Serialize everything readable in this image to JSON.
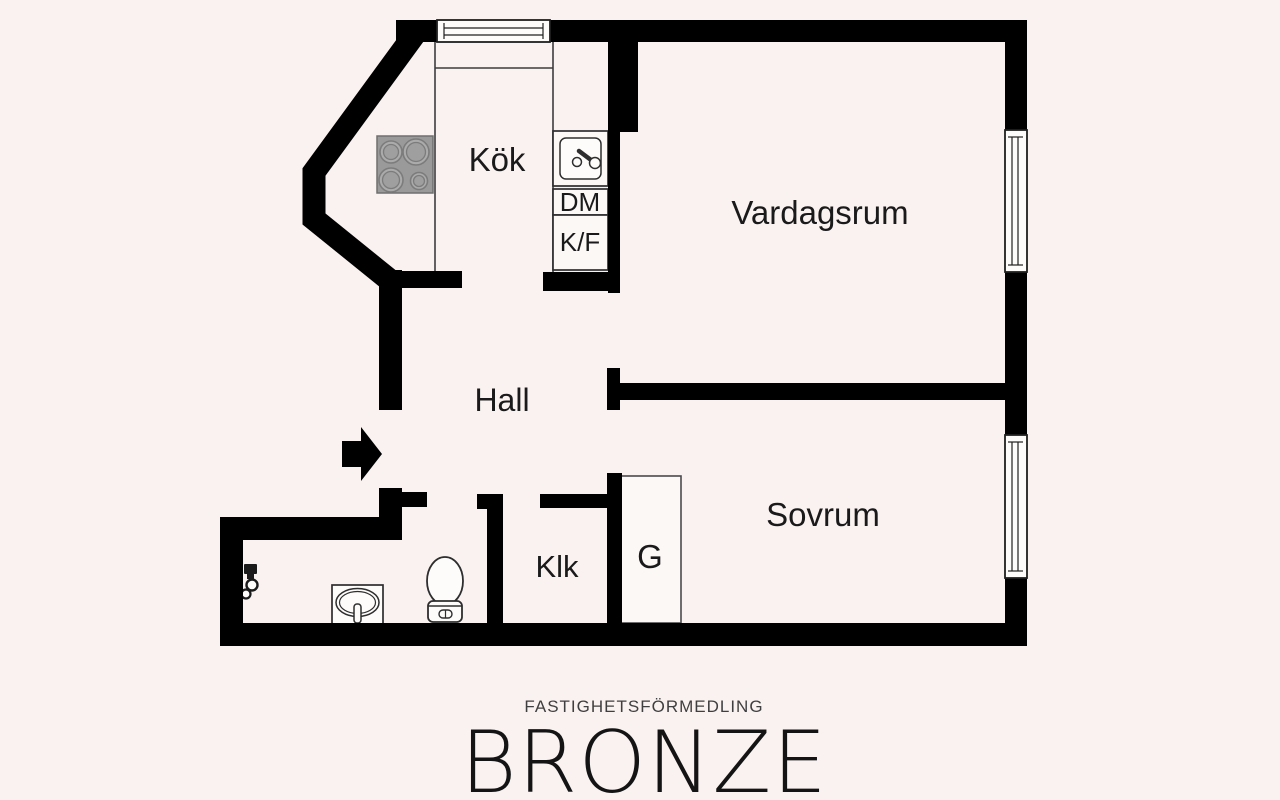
{
  "page": {
    "type": "apartment-floor-plan"
  },
  "labels": {
    "kitchen": "Kök",
    "living_room": "Vardagsrum",
    "hall": "Hall",
    "bedroom": "Sovrum",
    "closet": "Klk",
    "wardrobe": "G",
    "dishwasher": "DM",
    "fridge_freezer": "K/F"
  },
  "branding": {
    "tagline": "FASTIGHETSFÖRMEDLING",
    "name": "BRONZE"
  },
  "colors": {
    "background": "#f9f2f0",
    "wall": "#000000",
    "counter_line": "#3c3c3c",
    "fixture_outline": "#2e2e2e",
    "stove_fill": "#9a9a9a",
    "label_text": "#1a1a1a",
    "tagline_text": "#3f3f3f",
    "brand_text": "#141414"
  },
  "icons": {
    "entrance": "entrance-arrow-icon",
    "stove": "stove-icon",
    "kitchen_sink": "kitchen-sink-icon",
    "toilet": "toilet-icon",
    "washbasin": "washbasin-icon",
    "shower_mixer": "shower-mixer-icon",
    "window": "window-icon"
  }
}
